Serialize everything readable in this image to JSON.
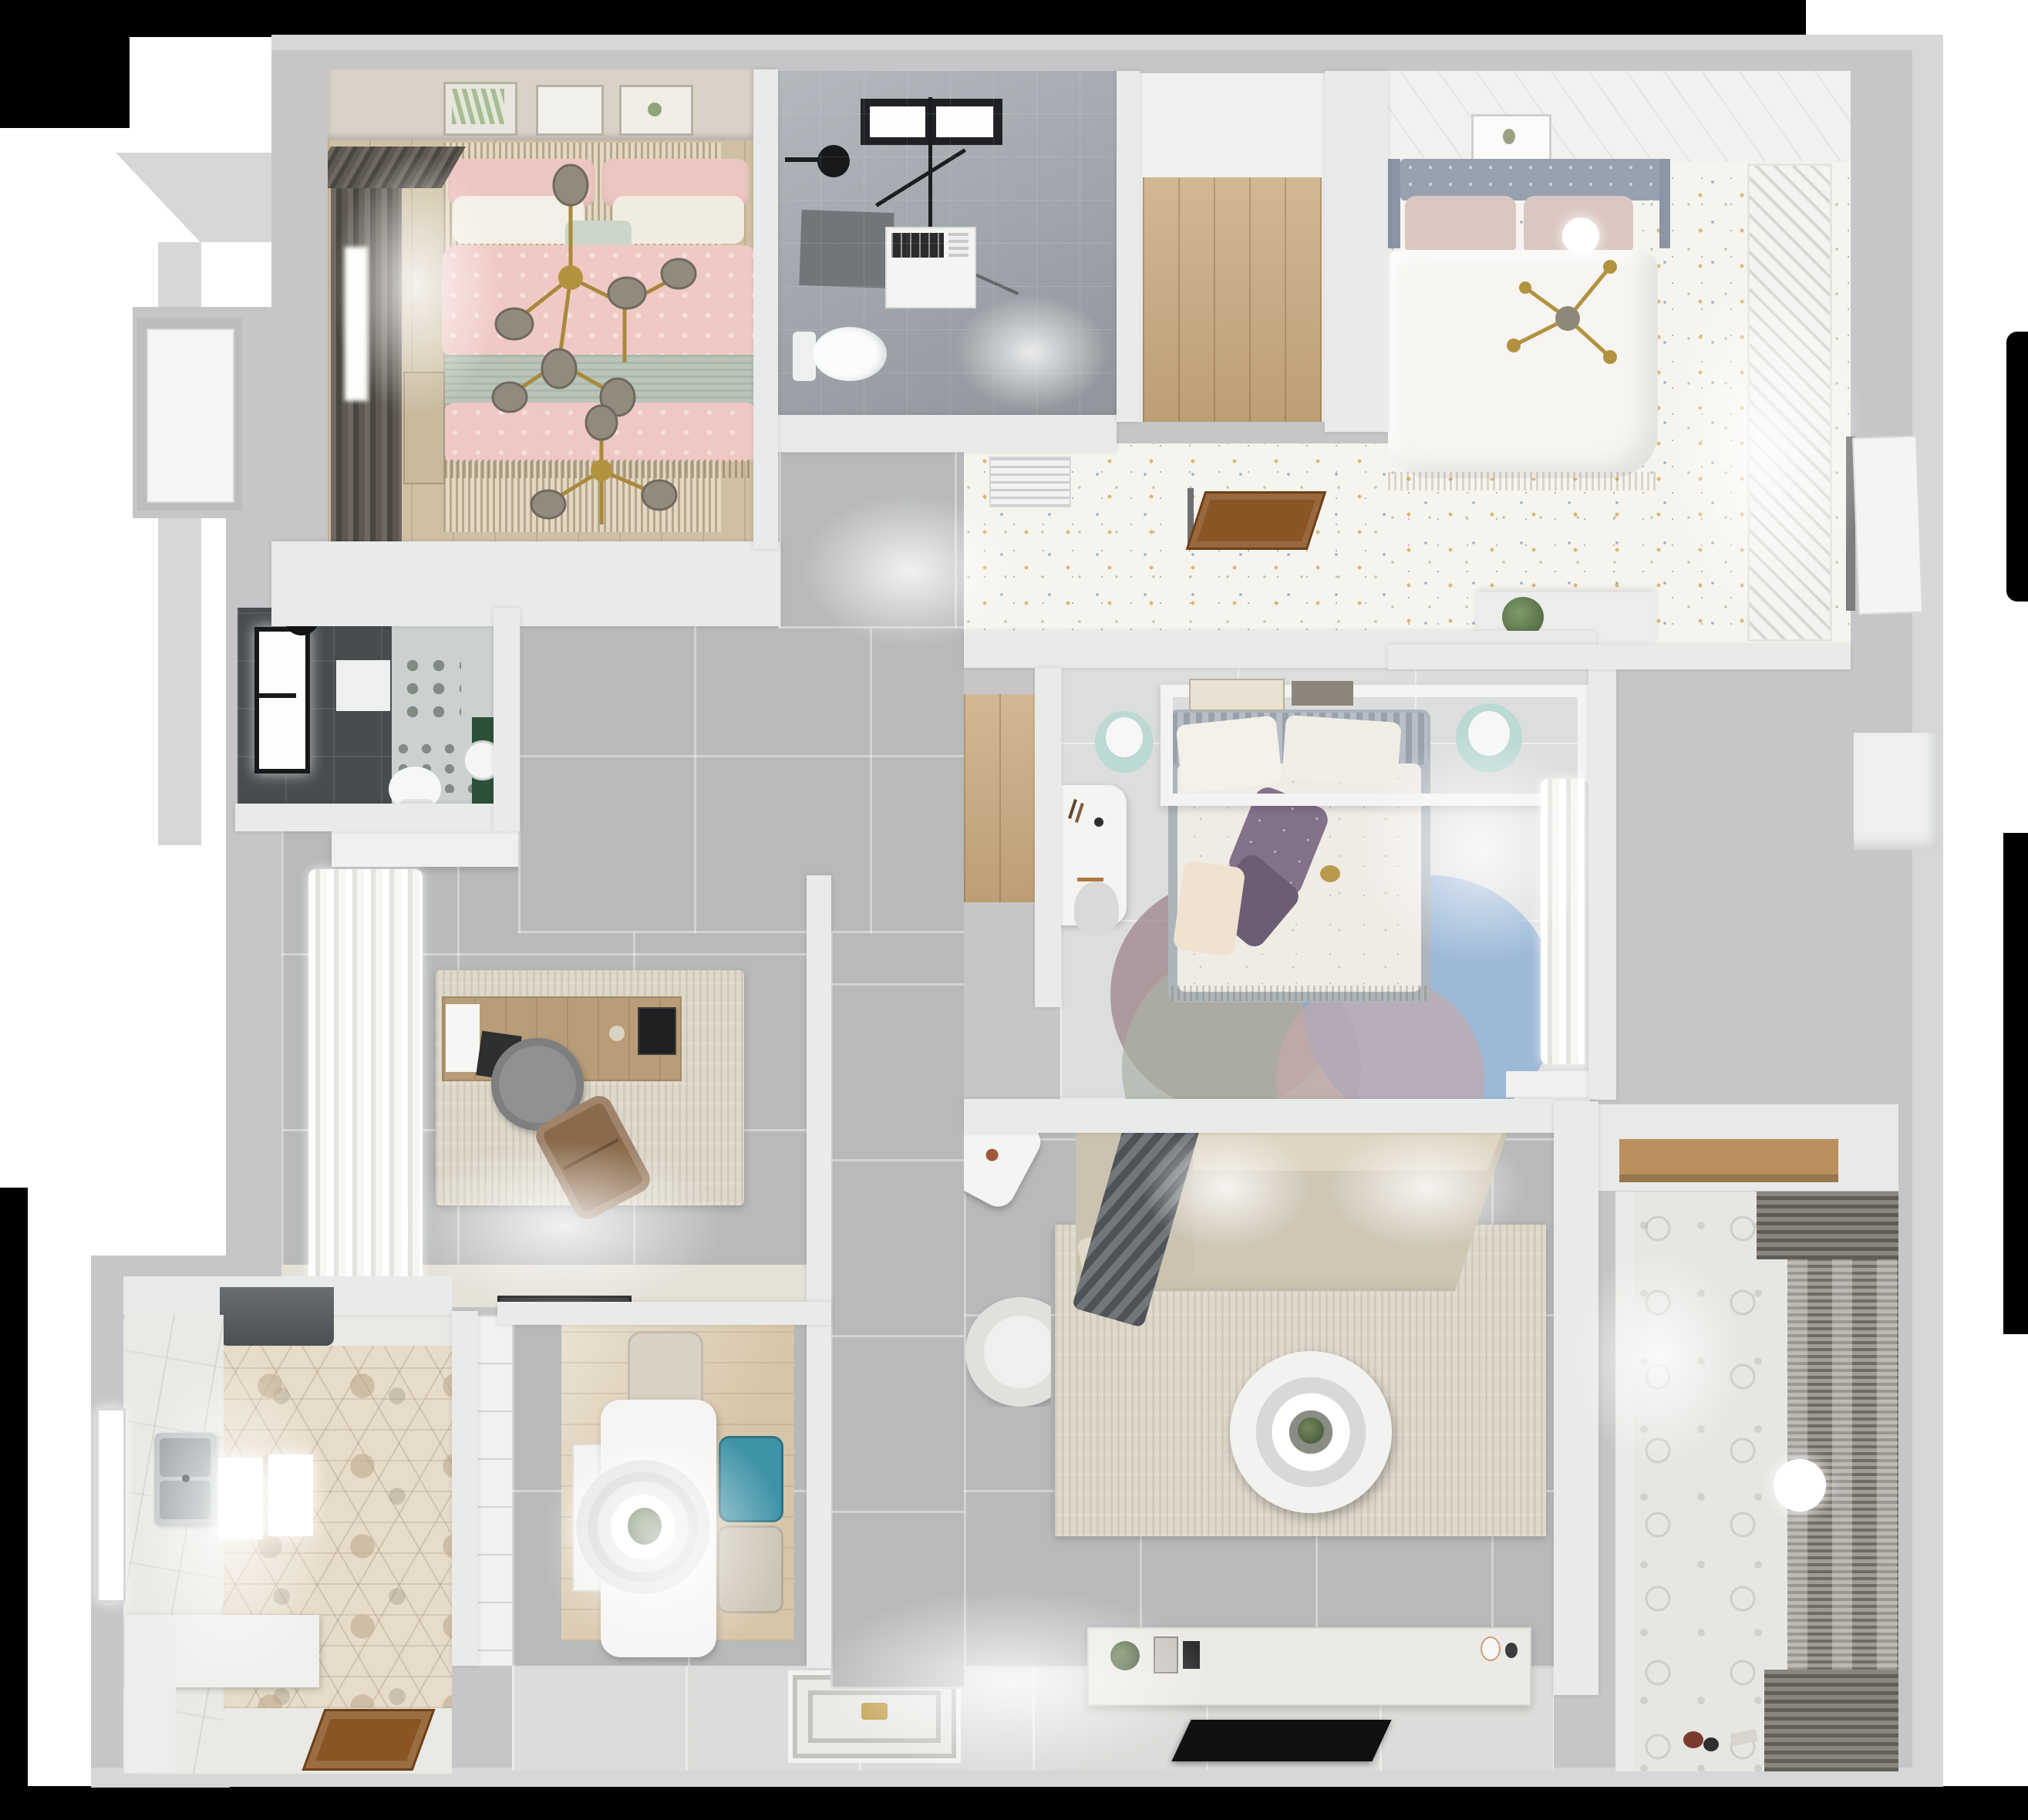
{
  "scene": {
    "type": "3d-floor-plan-render",
    "view": "top-down-dollhouse",
    "description": "Photorealistic top-down 3D render of an apartment floor plan with three bedrooms, two bathrooms, study, kitchen, dining, living room and balcony",
    "background": "white matte with irregular black edges"
  },
  "palette": {
    "wall_outer": "#c6c6c8",
    "wall_face": "#d7d7d9",
    "wall_inner": "#e9eaea",
    "floor_tile": "#b7b9ba",
    "floor_light": "#dcdedd",
    "floor_entry": "#dcddda",
    "confetti": "#f6f4ef",
    "wood_hall": "#c9a87c",
    "wood_bed": "#cfc0a4",
    "wood_door": "#8a5524",
    "wood_shelf": "#b98f5e",
    "hex_base": "#e7dcc9",
    "rug_living": "#ddd8ca",
    "sofa_beige": "#cfc6b4",
    "sofa_back": "#ded5c2",
    "pink_bed": "#f0c9c4",
    "sage": "#b8c5b8",
    "mint_stool": "#bcd9d3",
    "teal_chair": "#3f93a7",
    "purple_pillow": "#84718a",
    "blue_rug": "#85abd6",
    "mauve_rug": "#9b7f87",
    "sagerug": "#a9b2a5",
    "pinkrug": "#c4a7ab",
    "gold": "#b3923f",
    "glass_bulb": "#928b7d",
    "dark_shower": "#474c4f",
    "black_fixture": "#1b1d1f",
    "headboard_blue": "#97a1b0",
    "blush_pillow": "#dbc7c1",
    "balcony_blind_dark": "#7b776f",
    "green_plant": "#5d7a4e"
  },
  "rooms": [
    {
      "id": "bedroom-pink",
      "label": "small bedroom",
      "furniture": [
        "double-bed-pink",
        "branch-chandelier",
        "three-wall-frames",
        "dark-curtains",
        "window",
        "rug",
        "dresser"
      ]
    },
    {
      "id": "bathroom-main",
      "label": "bathroom",
      "furniture": [
        "dark-window",
        "shower-head",
        "glass-shower-frame",
        "washing-machine",
        "toilet"
      ]
    },
    {
      "id": "walkin-hall",
      "label": "walk-in hallway",
      "furniture": [
        "wood-floor"
      ]
    },
    {
      "id": "bedroom-master",
      "label": "master bedroom",
      "furniture": [
        "double-bed-white",
        "tufted-headboard",
        "pendant-ball-lamp",
        "gold-chandelier",
        "louver-wardrobe",
        "wall-frame",
        "plant-half-wall",
        "confetti-floor"
      ]
    },
    {
      "id": "suite-hall",
      "label": "suite hallway",
      "furniture": [
        "ac-vent",
        "open-wood-door",
        "confetti-floor"
      ]
    },
    {
      "id": "bedroom-middle",
      "label": "middle bedroom",
      "furniture": [
        "bed-floral",
        "headboard-shelf",
        "books",
        "mint-stool-left",
        "mint-stool-right",
        "white-desk",
        "desk-chair",
        "overlap-circle-rug",
        "white-curtains",
        "wood-alcove"
      ]
    },
    {
      "id": "bathroom-dark",
      "label": "shower bathroom",
      "furniture": [
        "dark-tiled-shower",
        "glowing-window",
        "towel-square",
        "toilet",
        "green-cabinet",
        "round-mirror"
      ]
    },
    {
      "id": "study",
      "label": "study",
      "furniture": [
        "white-curtains",
        "distressed-rug",
        "wood-desk",
        "paper",
        "laptop",
        "tablet",
        "round-gray-chair",
        "brown-lounge-chair",
        "dark-doormat",
        "top-cabinet"
      ]
    },
    {
      "id": "kitchen",
      "label": "kitchen",
      "furniture": [
        "range-hood",
        "double-sink",
        "hex-tile-floor",
        "white-counter",
        "light-panels",
        "window",
        "open-wood-entry-door"
      ]
    },
    {
      "id": "dining",
      "label": "dining",
      "furniture": [
        "white-table",
        "pendant-ring-lamp",
        "beige-chair-top",
        "teal-chair",
        "beige-chair-bottom",
        "white-sideboard",
        "wood-rug",
        "pantry-shelves"
      ]
    },
    {
      "id": "entry",
      "label": "entry corridor",
      "furniture": [
        "patterned-doormat"
      ]
    },
    {
      "id": "living",
      "label": "living room",
      "furniture": [
        "l-shaped-sofa",
        "gray-throw",
        "cream-rug",
        "ring-coffee-table",
        "tilted-white-stool",
        "round-white-armchair",
        "tv-console",
        "console-decor",
        "flat-tv"
      ]
    },
    {
      "id": "storage",
      "label": "storage niche",
      "furniture": [
        "wood-shelf"
      ]
    },
    {
      "id": "balcony",
      "label": "balcony",
      "furniture": [
        "roller-blinds",
        "patterned-tile-floor",
        "round-ceiling-light",
        "floor-toys"
      ]
    },
    {
      "id": "exterior",
      "label": "exterior",
      "furniture": [
        "white-entry-door-left",
        "white-side-door-right",
        "white-niche-box"
      ]
    }
  ]
}
